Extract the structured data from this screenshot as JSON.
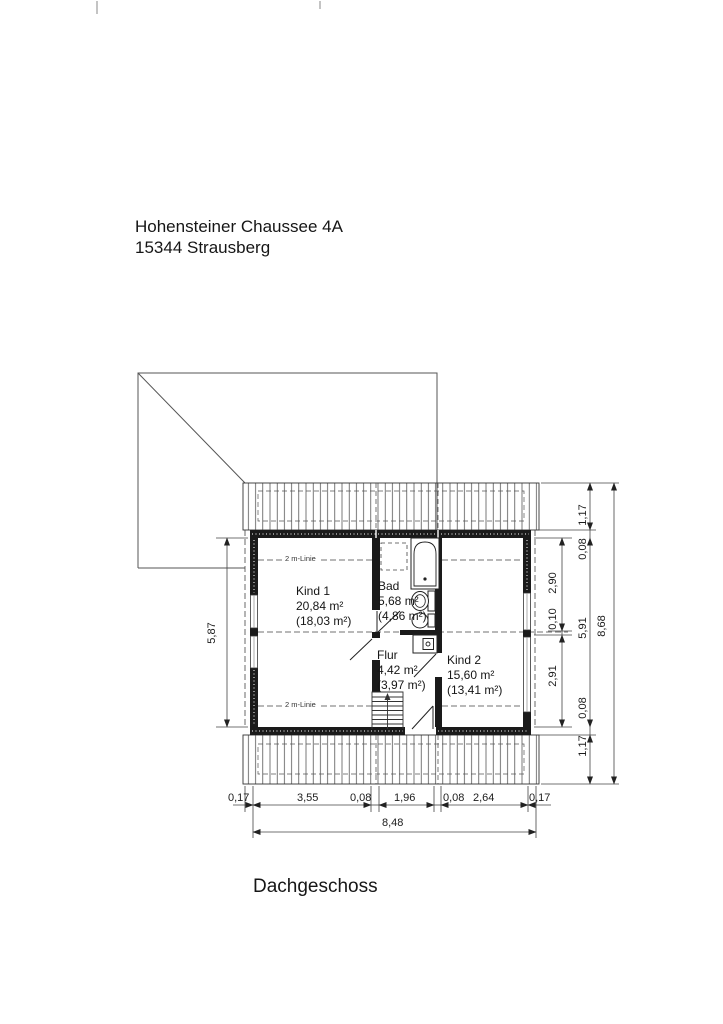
{
  "document": {
    "address_line1": "Hohensteiner Chaussee 4A",
    "address_line2": "15344 Strausberg",
    "plan_title": "Dachgeschoss"
  },
  "rooms": {
    "kind1": {
      "name": "Kind 1",
      "area": "20,84 m²",
      "reduced": "(18,03 m²)"
    },
    "bad": {
      "name": "Bad",
      "area": "5,68 m²",
      "reduced": "(4,86 m²)"
    },
    "flur": {
      "name": "Flur",
      "area": "4,42 m²",
      "reduced": "(3,97 m²)"
    },
    "kind2": {
      "name": "Kind 2",
      "area": "15,60 m²",
      "reduced": "(13,41 m²)"
    }
  },
  "annotations": {
    "two_m_linie": "2 m-Linie"
  },
  "dimensions": {
    "left_height": "5,87",
    "right_inner": [
      "2,90",
      "0,10",
      "2,91"
    ],
    "right_mid": [
      "1,17",
      "0,08",
      "5,91",
      "0,08",
      "1,17"
    ],
    "right_total": "8,68",
    "bottom_segments": [
      "0,17",
      "3,55",
      "0,08",
      "1,96",
      "0,08",
      "2,64",
      "0,17"
    ],
    "bottom_total": "8,48"
  },
  "colors": {
    "ink": "#1a1a1a",
    "paper": "#ffffff"
  }
}
